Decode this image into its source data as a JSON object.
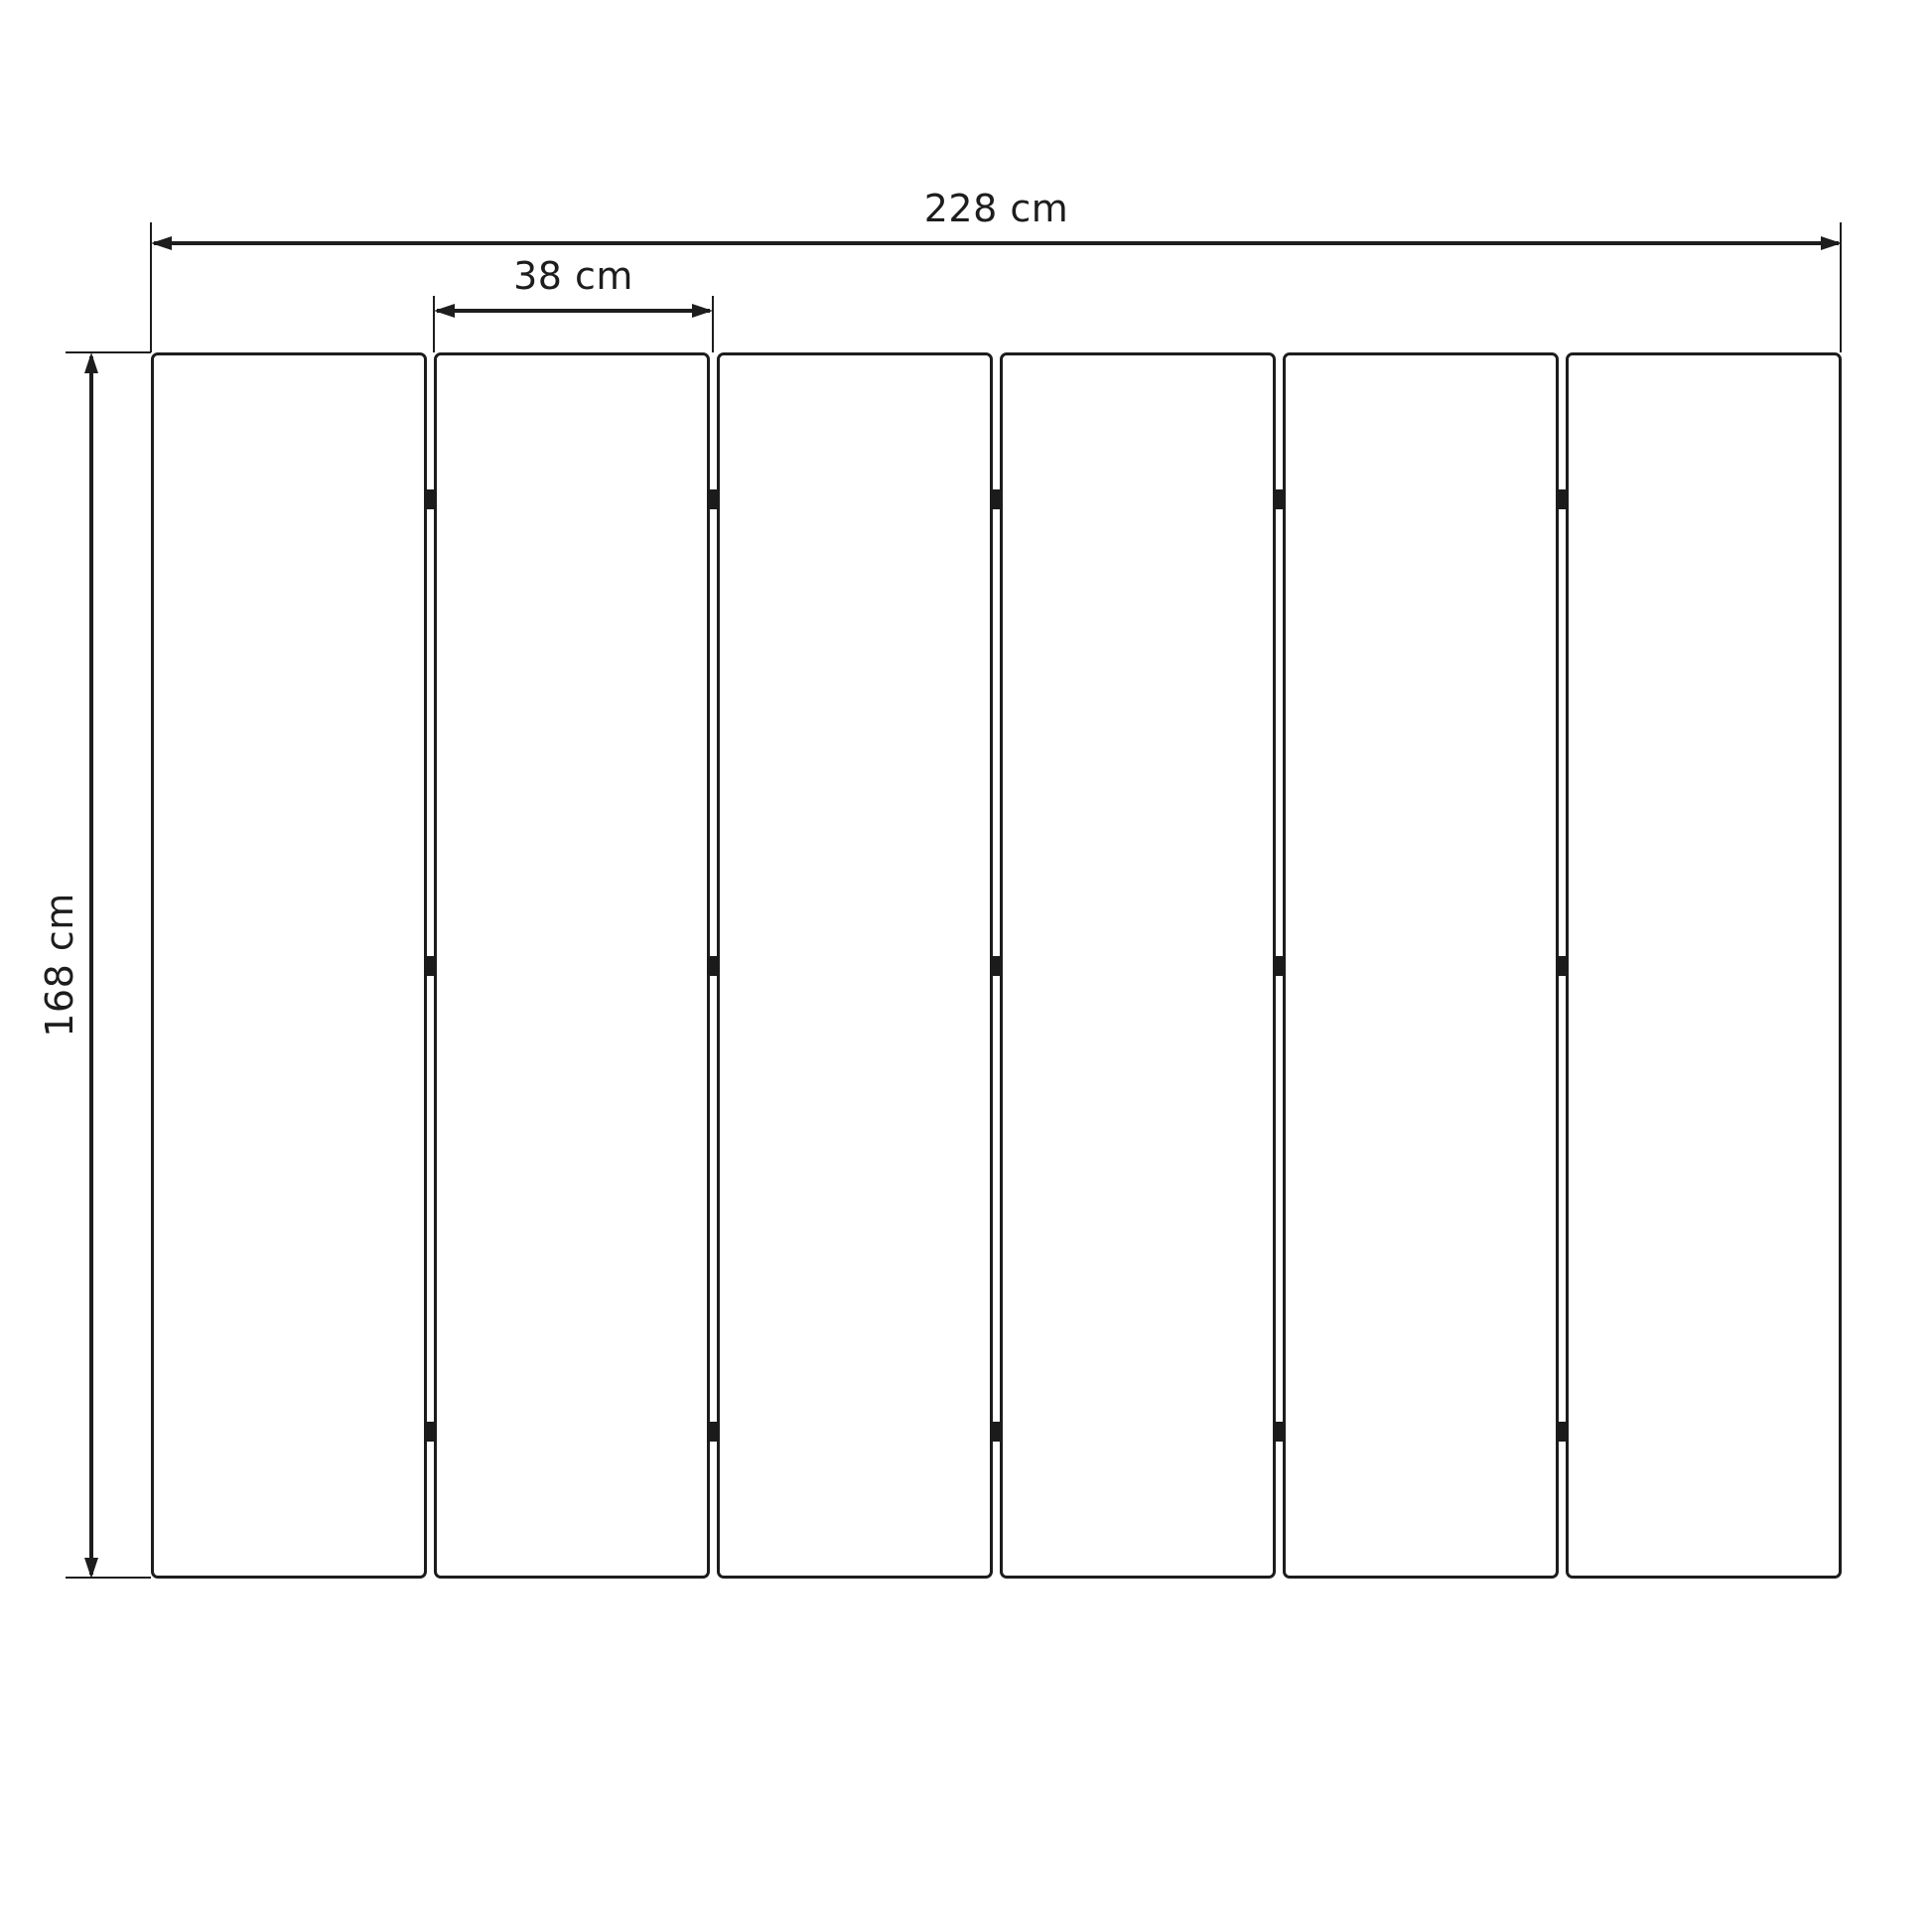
{
  "diagram": {
    "kind": "dimension-drawing",
    "subject": "six-panel folding screen, front elevation",
    "labels": {
      "total_width": "228 cm",
      "panel_width": "38 cm",
      "panel_height": "168 cm"
    },
    "panels": {
      "count": 6,
      "hinges_per_gap": 3
    },
    "colors": {
      "line": "#1d1d1d",
      "background": "#ffffff"
    }
  }
}
